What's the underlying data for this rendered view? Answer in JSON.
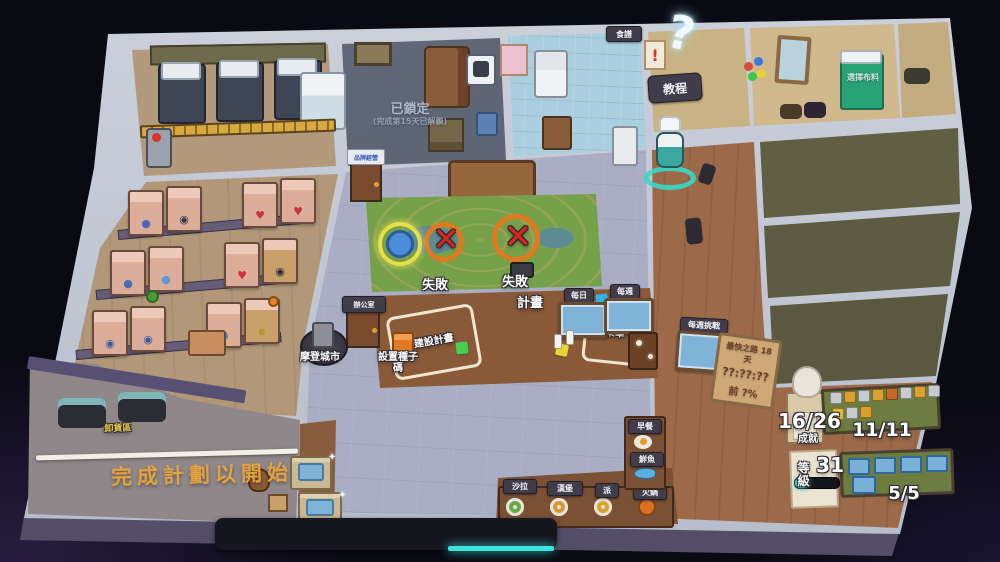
{
  "palette": {
    "background": "#0a0a13",
    "wall": "#c2c8d4",
    "wall_outline": "#262233",
    "floor_wood": "#9c6a49",
    "floor_hall": "#a9aec4",
    "floor_tan": "#b29878",
    "floor_locked": "#5c6473",
    "floor_kitchen": "#a9cfe0",
    "floor_green_room": "#5d5b41",
    "map_table_green": "#76a14a",
    "accent_cyan": "#3fe3df",
    "banner_orange": "#e2a23e",
    "zone_yellow": "#e9c842",
    "fail_red": "#d8271a",
    "ring_orange": "#e07a20"
  },
  "signs": {
    "recipes": "食譜",
    "alert": "!",
    "tutorial": "教程",
    "question": "?",
    "franchise_door": "品牌經營",
    "office_door": "辦公室"
  },
  "locked_room": {
    "title": "已鎖定",
    "subtitle": "(完成第15天已解鎖)"
  },
  "map_table": {
    "fail_left": "失敗",
    "fail_right": "失敗"
  },
  "planning_table": {
    "title": "計畫",
    "blueprint": "建設計畫",
    "menu": "菜單"
  },
  "stations": {
    "seed": "設置種子碼",
    "city": "摩登城市"
  },
  "dock": {
    "zone": "卸貨區",
    "banner": "完成計劃以開始"
  },
  "boards": {
    "daily": "每日",
    "weekly": "每週",
    "weekly_challenge": "每週挑戰"
  },
  "speedrun_sign": {
    "route": "最快之路 18 天",
    "time": "??:??:??",
    "percent": "前 ?%"
  },
  "bedroom_hint": "選擇布料",
  "dishes": {
    "row": [
      "沙拉",
      "漢堡",
      "派",
      "火鍋"
    ],
    "column": [
      "早餐",
      "鮮魚"
    ]
  },
  "progress": {
    "achievements_value": "16/26",
    "achievements_label": "成就",
    "badges_value": "11/11",
    "level_label": "等級",
    "level_value": "31",
    "level_fill_percent": 32,
    "paintings_value": "5/5"
  }
}
